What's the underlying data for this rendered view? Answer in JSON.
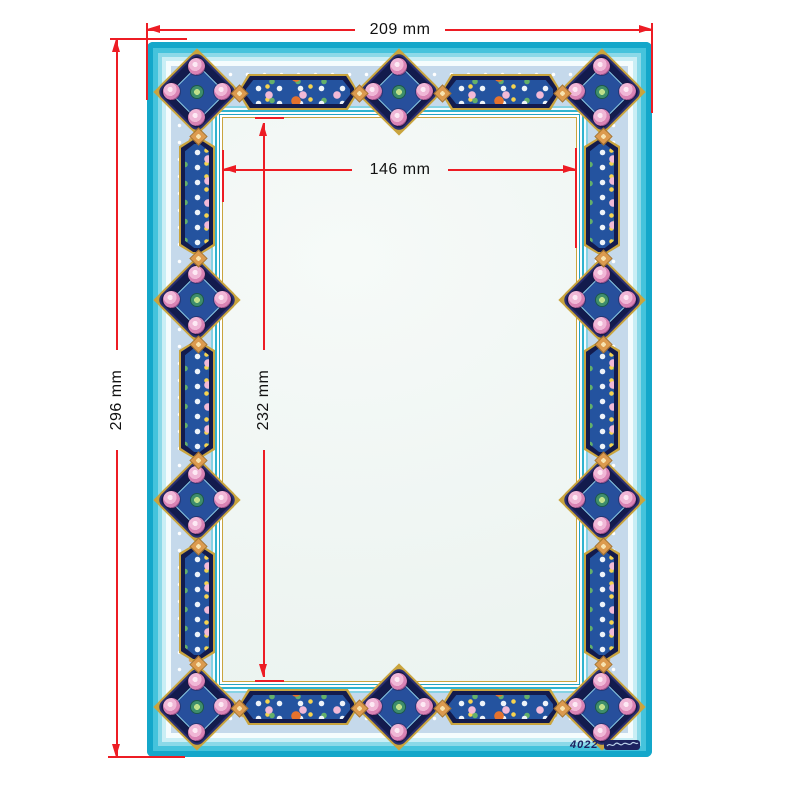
{
  "annotations": {
    "outer_width_label": "209 mm",
    "outer_height_label": "296 mm",
    "inner_width_label": "146 mm",
    "inner_height_label": "232 mm"
  },
  "signature": {
    "code": "4022"
  },
  "colors": {
    "dimension_red": "#ed1c24",
    "frame_teal": "#14a7ca",
    "cartouche_navy": "#131b4d",
    "panel_blue": "#24539f",
    "gold": "#c9a43e",
    "band_periwinkle": "#c5d9eb",
    "paper": "#edf4f1",
    "flower_pink": "#f0b7d6"
  }
}
